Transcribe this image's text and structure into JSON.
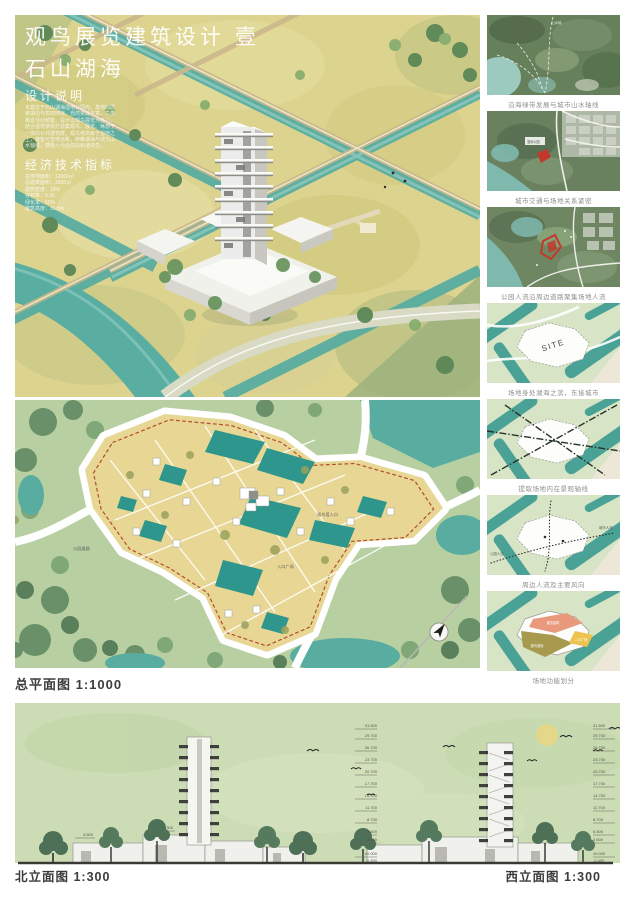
{
  "hero": {
    "title": "观鸟展览建筑设计 壹",
    "subtitle": "石山湖海",
    "design_notes_heading": "设计说明",
    "design_notes_lines": "本案位于石山湖海湿地公园内，基地四周\n被湖泊与农田环绕，自然资源丰富，鸟类\n栖息活动频繁。设计以观鸟展览为核心，\n结合湿地景观打造集观鸟、展览、休憩于\n一体的公共建筑群。观鸟塔高耸于湿地之\n上，游客可登塔远眺，俯瞰湖海与城市山\n水轴线，感受人与自然的和谐共生。",
    "indicators_heading": "经济技术指标",
    "indicators_lines": "总用地面积：12000㎡\n总建筑面积：3600㎡\n建筑密度：18%\n容积率：0.30\n绿化率：65%\n建筑高度：31.5m"
  },
  "right_column": {
    "panels": [
      {
        "caption": "沿海绿带发展与城市山水轴线"
      },
      {
        "caption": "城市交通与场地关系紧密"
      },
      {
        "caption": "公园人流沿周边道路聚集场地人流"
      },
      {
        "caption": "场地身处湖海之滨，东接城市",
        "site_label": "SITE"
      },
      {
        "caption": "提取场地内在景观轴线"
      },
      {
        "caption": "周边人流及主要风向",
        "label_left": "公园人流",
        "label_right": "城市人流"
      },
      {
        "caption": "场地功能划分",
        "zone_a": "展览建筑",
        "zone_b": "观鸟湿地",
        "zone_c": "入口广场"
      }
    ]
  },
  "site_plan": {
    "label": "总平面图 1:1000",
    "annotations": {
      "entry": "观鸟塔入口",
      "road": "公园道路",
      "plaza": "入口广场"
    }
  },
  "elevations": {
    "north_label": "北立面图 1:300",
    "west_label": "西立面图 1:300",
    "levels": [
      "31.500",
      "29.700",
      "26.700",
      "23.700",
      "20.700",
      "17.700",
      "14.700",
      "11.700",
      "8.700",
      "5.400",
      "3.600",
      "±0.000",
      "-0.450"
    ],
    "north_base_levels": {
      "a": "4.500",
      "b": "6.300"
    }
  },
  "colors": {
    "field_yellow": "#dcd38f",
    "water_teal": "#59ada1",
    "plan_green": "#b8cfa1",
    "plot_teal": "#2e968c",
    "site_tan": "#e8d794",
    "boundary_red": "#b5502f",
    "elevation_bg": "#ccddb5",
    "zone_salmon": "#ea9a7c",
    "zone_olive": "#a79a4f",
    "zone_yellow": "#eec24d"
  }
}
